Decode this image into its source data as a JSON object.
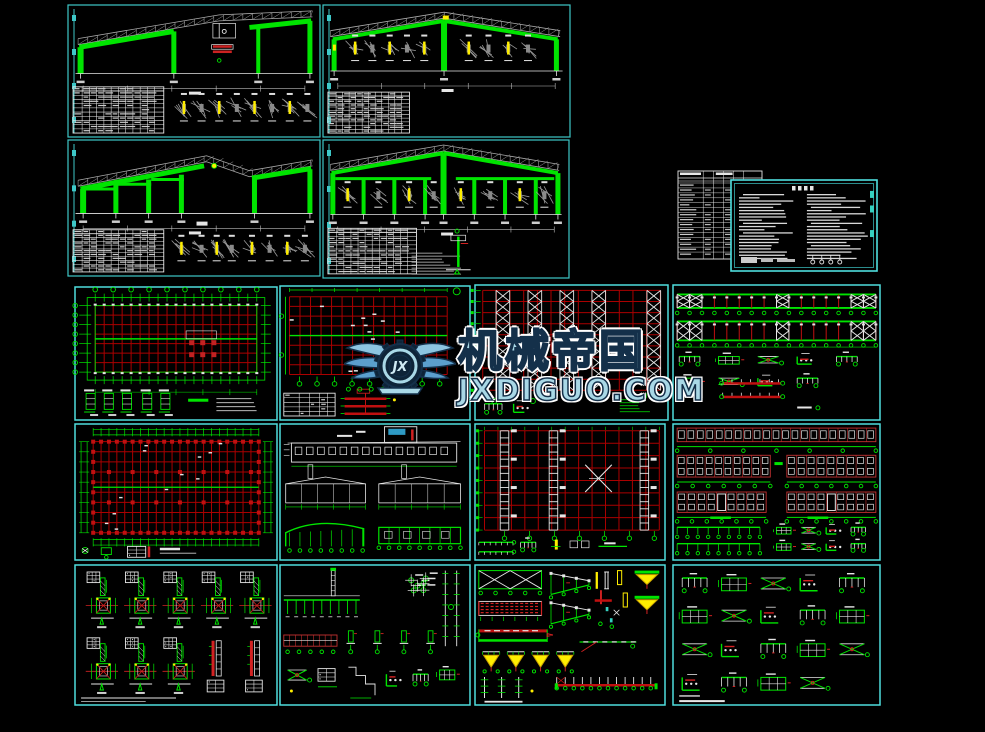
{
  "app": {
    "kind": "cad-drawing-sheet-grid",
    "background": "#000000"
  },
  "watermark": {
    "brand": "机械帝国",
    "domain": "JXDIGUO.COM",
    "monogram": "JX",
    "fill": "#a9d8e6",
    "outline": "#14304a",
    "wing": "#5b9fcd",
    "wing_light": "#8cc4e0",
    "gear_dark": "#0e2438"
  },
  "palette": {
    "panel_border": "#3ec8c8",
    "panel_border_bright": "#4fdede",
    "cad_green": "#00e400",
    "cad_red": "#aa0000",
    "cad_bright_red": "#d22222",
    "cad_white": "#e6e6e6",
    "cad_gray": "#9a9a9a",
    "cad_yellow": "#ffee00",
    "cad_cyan": "#35d0c0",
    "cad_blue": "#2e9ac4"
  },
  "panels": [
    {
      "id": "A",
      "name": "frame-elevation-1",
      "type": "frame-a",
      "x": 68,
      "y": 5,
      "w": 252,
      "h": 132,
      "border": "normal"
    },
    {
      "id": "B",
      "name": "frame-elevation-2",
      "type": "frame-b",
      "x": 323,
      "y": 5,
      "w": 247,
      "h": 132,
      "border": "normal"
    },
    {
      "id": "C",
      "name": "frame-elevation-3",
      "type": "frame-c",
      "x": 68,
      "y": 140,
      "w": 252,
      "h": 136,
      "border": "normal"
    },
    {
      "id": "D",
      "name": "frame-elevation-4",
      "type": "frame-d",
      "x": 323,
      "y": 140,
      "w": 246,
      "h": 138,
      "border": "normal"
    },
    {
      "id": "E",
      "name": "member-schedule-table",
      "type": "schedule",
      "x": 678,
      "y": 171,
      "w": 84,
      "h": 88,
      "border": "white"
    },
    {
      "id": "F",
      "name": "general-notes",
      "type": "notes",
      "x": 731,
      "y": 180,
      "w": 146,
      "h": 91,
      "border": "bright"
    },
    {
      "id": "G",
      "name": "foundation-plan",
      "type": "foundation",
      "x": 75,
      "y": 287,
      "w": 202,
      "h": 133,
      "border": "bright"
    },
    {
      "id": "H",
      "name": "column-grid-plan",
      "type": "gridplan",
      "x": 280,
      "y": 286,
      "w": 190,
      "h": 134,
      "border": "bright"
    },
    {
      "id": "I",
      "name": "roof-bracing-plan",
      "type": "bracingplan",
      "x": 475,
      "y": 285,
      "w": 193,
      "h": 135,
      "border": "bright"
    },
    {
      "id": "J",
      "name": "wall-bracing-elevations",
      "type": "bracingelev",
      "x": 673,
      "y": 285,
      "w": 207,
      "h": 135,
      "border": "bright"
    },
    {
      "id": "K",
      "name": "column-layout-plan",
      "type": "denseplan",
      "x": 75,
      "y": 424,
      "w": 202,
      "h": 136,
      "border": "bright"
    },
    {
      "id": "L",
      "name": "building-elevations",
      "type": "elevsheet",
      "x": 280,
      "y": 424,
      "w": 190,
      "h": 136,
      "border": "bright"
    },
    {
      "id": "M",
      "name": "purlin-layout-plan",
      "type": "purlinplan",
      "x": 475,
      "y": 424,
      "w": 190,
      "h": 136,
      "border": "bright"
    },
    {
      "id": "N",
      "name": "wall-framing-elevations",
      "type": "wallframing",
      "x": 673,
      "y": 424,
      "w": 207,
      "h": 136,
      "border": "bright"
    },
    {
      "id": "O",
      "name": "footing-details",
      "type": "footings",
      "x": 75,
      "y": 565,
      "w": 202,
      "h": 140,
      "border": "bright"
    },
    {
      "id": "P",
      "name": "connection-details-1",
      "type": "misc1",
      "x": 280,
      "y": 565,
      "w": 190,
      "h": 140,
      "border": "bright"
    },
    {
      "id": "Q",
      "name": "gusset-details",
      "type": "misc2",
      "x": 475,
      "y": 565,
      "w": 190,
      "h": 140,
      "border": "bright"
    },
    {
      "id": "R",
      "name": "connection-details-2",
      "type": "misc3",
      "x": 673,
      "y": 565,
      "w": 207,
      "h": 140,
      "border": "bright"
    }
  ]
}
